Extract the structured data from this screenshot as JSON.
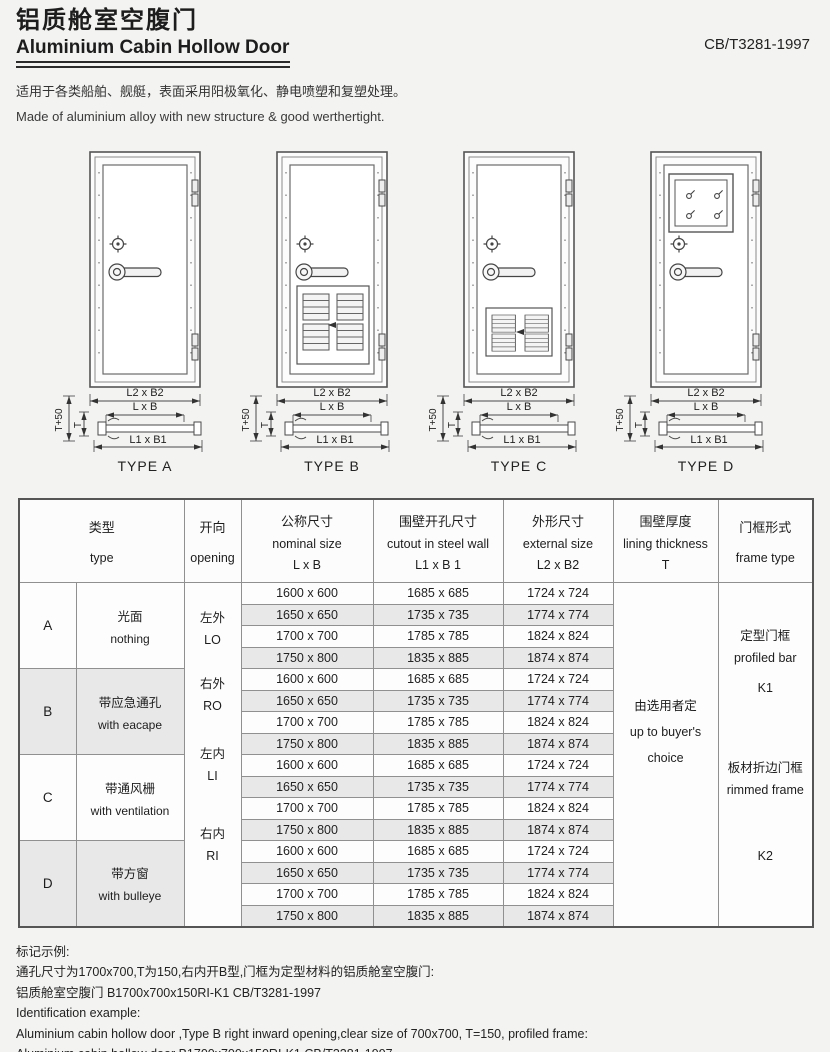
{
  "header": {
    "title_zh": "铝质舱室空腹门",
    "title_en": "Aluminium Cabin Hollow Door",
    "standard": "CB/T3281-1997",
    "intro_zh": "适用于各类船舶、舰艇，表面采用阳极氧化、静电喷塑和复塑处理。",
    "intro_en": "Made of aluminium alloy with new structure & good werthertight."
  },
  "diagrams": {
    "dim_labels": {
      "outer": "L2 x B2",
      "nominal": "L x B",
      "cutout": "L1 x B1",
      "t_plus_50": "T+50",
      "t": "T"
    },
    "types": [
      {
        "caption": "TYPE A",
        "feature": "plain door"
      },
      {
        "caption": "TYPE B",
        "feature": "door with escape louver panel"
      },
      {
        "caption": "TYPE C",
        "feature": "door with ventilation louver"
      },
      {
        "caption": "TYPE D",
        "feature": "door with square window"
      }
    ]
  },
  "table": {
    "headers": {
      "type_zh": "类型",
      "type_en": "type",
      "opening_zh": "开向",
      "opening_en": "opening",
      "nominal_zh": "公称尺寸",
      "nominal_en": "nominal size",
      "nominal_sub": "L x B",
      "cutout_zh": "围壁开孔尺寸",
      "cutout_en": "cutout in steel wall",
      "cutout_sub": "L1 x B 1",
      "external_zh": "外形尺寸",
      "external_en": "external size",
      "external_sub": "L2 x B2",
      "lining_zh": "围壁厚度",
      "lining_en": "lining thickness",
      "lining_sub": "T",
      "frame_zh": "门框形式",
      "frame_en": "frame type"
    },
    "groups": [
      {
        "letter": "A",
        "desc_zh": "光面",
        "desc_en": "nothing",
        "rows": [
          [
            "1600 x 600",
            "1685 x 685",
            "1724 x 724"
          ],
          [
            "1650 x 650",
            "1735 x 735",
            "1774 x 774"
          ],
          [
            "1700 x 700",
            "1785 x 785",
            "1824 x 824"
          ],
          [
            "1750 x 800",
            "1835 x 885",
            "1874 x 874"
          ]
        ]
      },
      {
        "letter": "B",
        "desc_zh": "带应急通孔",
        "desc_en": "with eacape",
        "rows": [
          [
            "1600 x 600",
            "1685 x 685",
            "1724 x 724"
          ],
          [
            "1650 x 650",
            "1735 x 735",
            "1774 x 774"
          ],
          [
            "1700 x 700",
            "1785 x 785",
            "1824 x 824"
          ],
          [
            "1750 x 800",
            "1835 x 885",
            "1874 x 874"
          ]
        ]
      },
      {
        "letter": "C",
        "desc_zh": "带通风栅",
        "desc_en": "with ventilation",
        "rows": [
          [
            "1600 x 600",
            "1685 x 685",
            "1724 x 724"
          ],
          [
            "1650 x 650",
            "1735 x 735",
            "1774 x 774"
          ],
          [
            "1700 x 700",
            "1785 x 785",
            "1824 x 824"
          ],
          [
            "1750 x 800",
            "1835 x 885",
            "1874 x 874"
          ]
        ]
      },
      {
        "letter": "D",
        "desc_zh": "带方窗",
        "desc_en": "with bulleye",
        "rows": [
          [
            "1600 x 600",
            "1685 x 685",
            "1724 x 724"
          ],
          [
            "1650 x 650",
            "1735 x 735",
            "1774 x 774"
          ],
          [
            "1700 x 700",
            "1785 x 785",
            "1824 x 824"
          ],
          [
            "1750 x 800",
            "1835 x 885",
            "1874 x 874"
          ]
        ]
      }
    ],
    "openings": [
      {
        "zh": "左外",
        "en": "LO"
      },
      {
        "zh": "右外",
        "en": "RO"
      },
      {
        "zh": "左内",
        "en": "LI"
      },
      {
        "zh": "右内",
        "en": "RI"
      }
    ],
    "lining": {
      "zh": "由选用者定",
      "en_line1": "up to buyer's",
      "en_line2": "choice"
    },
    "frames": [
      {
        "zh": "定型门框",
        "en": "profiled bar",
        "code": "K1"
      },
      {
        "zh": "板材折边门框",
        "en": "rimmed frame",
        "code": "K2"
      }
    ]
  },
  "example": {
    "label_zh": "标记示例:",
    "desc_zh": "通孔尺寸为1700x700,T为150,右内开B型,门框为定型材料的铝质舱室空腹门:",
    "code_zh": "铝质舱室空腹门 B1700x700x150RI-K1 CB/T3281-1997",
    "label_en": "Identification example:",
    "desc_en": "Aluminium cabin hollow door ,Type B right inward opening,clear size of 700x700, T=150, profiled frame:",
    "code_en": "Aluminium cabin hollow door B1700x700x150RI-K1 CB/T3281-1997"
  }
}
